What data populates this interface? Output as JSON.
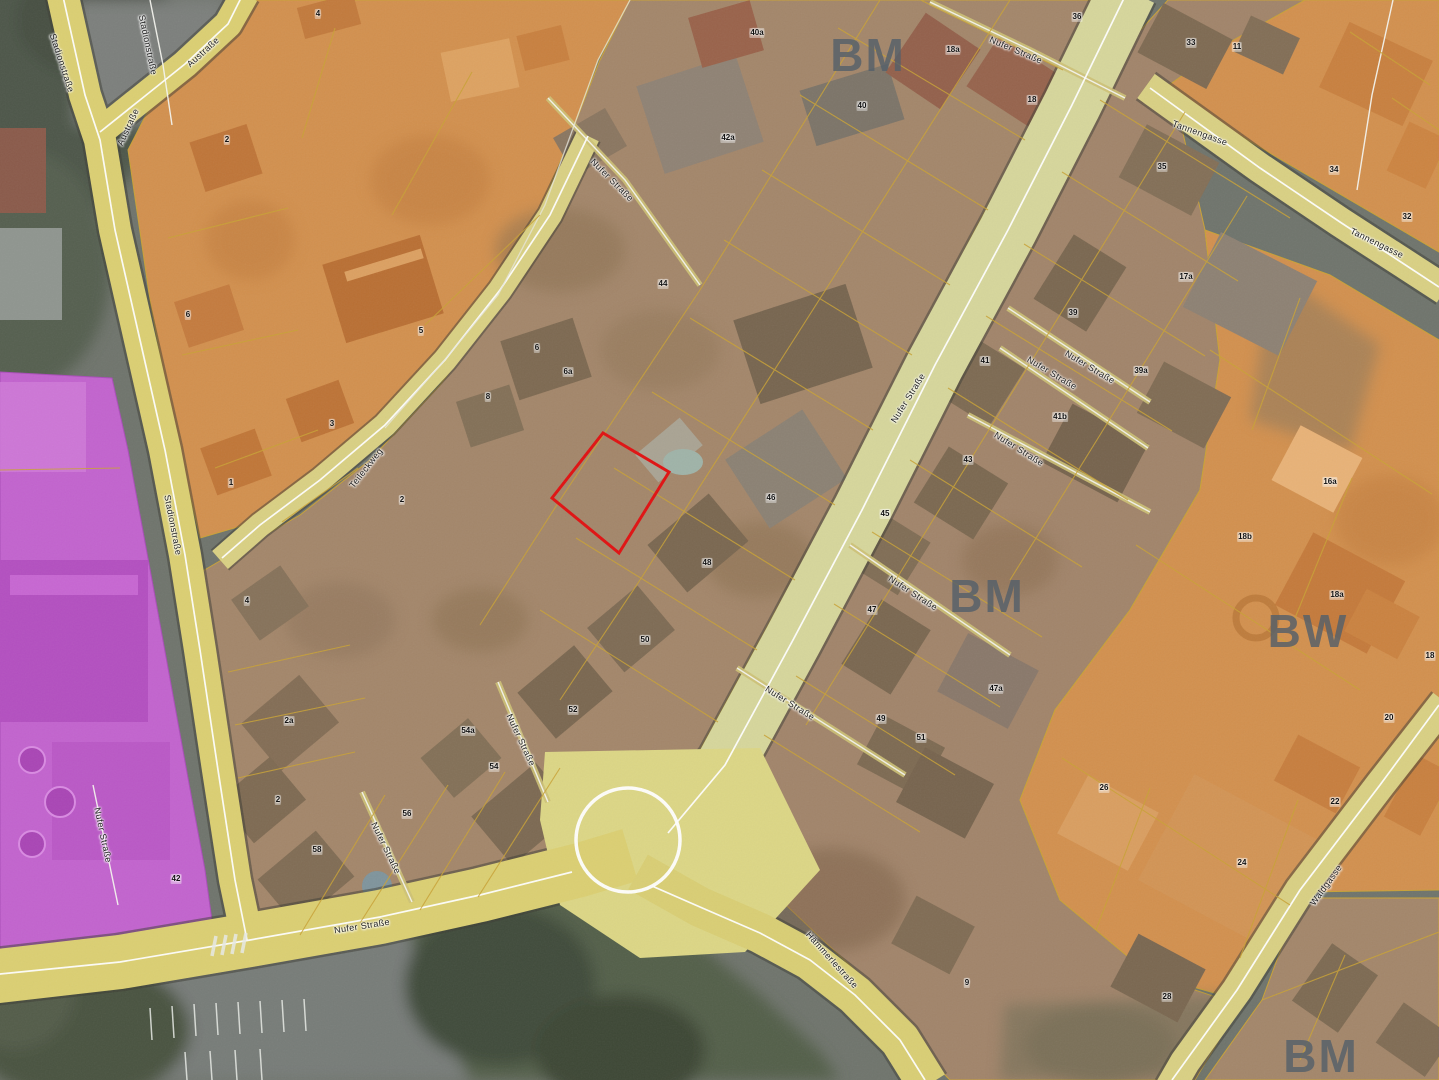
{
  "map": {
    "legend_colors": {
      "highlight_parcel_red": "#e01111",
      "mixed_use_brown": "#a3866a",
      "orange_zone": "#d2904e",
      "utility_purple": "#c263ce",
      "road_yellow": "#dbcf72",
      "aerial_gray": "#6f746c",
      "zone_label_gray": "#55606a"
    },
    "zone_labels": [
      {
        "text": "BM",
        "x": 868,
        "y": 55
      },
      {
        "text": "BM",
        "x": 987,
        "y": 596
      },
      {
        "text": "BW",
        "x": 1308,
        "y": 631
      },
      {
        "text": "BM",
        "x": 1321,
        "y": 1056
      }
    ],
    "street_labels": [
      {
        "text": "Stadionstraße",
        "x": 62,
        "y": 63,
        "rot": 72
      },
      {
        "text": "Stadionstraße",
        "x": 148,
        "y": 45,
        "rot": 78
      },
      {
        "text": "Austraße",
        "x": 203,
        "y": 52,
        "rot": -42
      },
      {
        "text": "Austraße",
        "x": 128,
        "y": 127,
        "rot": -65
      },
      {
        "text": "Stadionstraße",
        "x": 173,
        "y": 525,
        "rot": 79
      },
      {
        "text": "Teileckweg",
        "x": 366,
        "y": 468,
        "rot": -52
      },
      {
        "text": "Nufer Straße",
        "x": 103,
        "y": 835,
        "rot": 78
      },
      {
        "text": "Nufer Straße",
        "x": 362,
        "y": 926,
        "rot": -9
      },
      {
        "text": "Nufer Straße",
        "x": 908,
        "y": 398,
        "rot": -58
      },
      {
        "text": "Nufer Straße",
        "x": 1016,
        "y": 50,
        "rot": 23
      },
      {
        "text": "Nufer Straße",
        "x": 612,
        "y": 180,
        "rot": 45
      },
      {
        "text": "Nufer Straße",
        "x": 1052,
        "y": 373,
        "rot": 31
      },
      {
        "text": "Nufer Straße",
        "x": 1090,
        "y": 367,
        "rot": 31
      },
      {
        "text": "Nufer Straße",
        "x": 1019,
        "y": 449,
        "rot": 32
      },
      {
        "text": "Nufer Straße",
        "x": 913,
        "y": 593,
        "rot": 33
      },
      {
        "text": "Nufer Straße",
        "x": 790,
        "y": 703,
        "rot": 32
      },
      {
        "text": "Nufer Straße",
        "x": 521,
        "y": 740,
        "rot": 65
      },
      {
        "text": "Nufer Straße",
        "x": 386,
        "y": 848,
        "rot": 64
      },
      {
        "text": "Tannengasse",
        "x": 1200,
        "y": 133,
        "rot": 20
      },
      {
        "text": "Tannengasse",
        "x": 1377,
        "y": 243,
        "rot": 26
      },
      {
        "text": "Waldgasse",
        "x": 1326,
        "y": 885,
        "rot": -54
      },
      {
        "text": "Hämmerlestraße",
        "x": 832,
        "y": 960,
        "rot": 48
      }
    ],
    "parcel_numbers": [
      {
        "t": "4",
        "x": 318,
        "y": 14
      },
      {
        "t": "36",
        "x": 1077,
        "y": 17
      },
      {
        "t": "40a",
        "x": 757,
        "y": 33
      },
      {
        "t": "33",
        "x": 1191,
        "y": 43
      },
      {
        "t": "11",
        "x": 1237,
        "y": 47
      },
      {
        "t": "18a",
        "x": 953,
        "y": 50
      },
      {
        "t": "18",
        "x": 1032,
        "y": 100
      },
      {
        "t": "40",
        "x": 862,
        "y": 106
      },
      {
        "t": "42a",
        "x": 728,
        "y": 138
      },
      {
        "t": "2",
        "x": 227,
        "y": 140
      },
      {
        "t": "35",
        "x": 1162,
        "y": 167
      },
      {
        "t": "34",
        "x": 1334,
        "y": 170
      },
      {
        "t": "32",
        "x": 1407,
        "y": 217
      },
      {
        "t": "17a",
        "x": 1186,
        "y": 277
      },
      {
        "t": "44",
        "x": 663,
        "y": 284
      },
      {
        "t": "39",
        "x": 1073,
        "y": 313
      },
      {
        "t": "6",
        "x": 188,
        "y": 315
      },
      {
        "t": "5",
        "x": 421,
        "y": 331
      },
      {
        "t": "6",
        "x": 537,
        "y": 348
      },
      {
        "t": "41",
        "x": 985,
        "y": 361
      },
      {
        "t": "39a",
        "x": 1141,
        "y": 371
      },
      {
        "t": "6a",
        "x": 568,
        "y": 372
      },
      {
        "t": "8",
        "x": 488,
        "y": 397
      },
      {
        "t": "41b",
        "x": 1060,
        "y": 417
      },
      {
        "t": "3",
        "x": 332,
        "y": 424
      },
      {
        "t": "43",
        "x": 968,
        "y": 460
      },
      {
        "t": "16a",
        "x": 1330,
        "y": 482
      },
      {
        "t": "1",
        "x": 231,
        "y": 483
      },
      {
        "t": "46",
        "x": 771,
        "y": 498
      },
      {
        "t": "2",
        "x": 402,
        "y": 500
      },
      {
        "t": "45",
        "x": 885,
        "y": 514
      },
      {
        "t": "18b",
        "x": 1245,
        "y": 537
      },
      {
        "t": "48",
        "x": 707,
        "y": 563
      },
      {
        "t": "18a",
        "x": 1337,
        "y": 595
      },
      {
        "t": "4",
        "x": 247,
        "y": 601
      },
      {
        "t": "47",
        "x": 872,
        "y": 610
      },
      {
        "t": "50",
        "x": 645,
        "y": 640
      },
      {
        "t": "18",
        "x": 1430,
        "y": 656
      },
      {
        "t": "47a",
        "x": 996,
        "y": 689
      },
      {
        "t": "52",
        "x": 573,
        "y": 710
      },
      {
        "t": "20",
        "x": 1389,
        "y": 718
      },
      {
        "t": "49",
        "x": 881,
        "y": 719
      },
      {
        "t": "2a",
        "x": 289,
        "y": 721
      },
      {
        "t": "54a",
        "x": 468,
        "y": 731
      },
      {
        "t": "51",
        "x": 921,
        "y": 738
      },
      {
        "t": "54",
        "x": 494,
        "y": 767
      },
      {
        "t": "26",
        "x": 1104,
        "y": 788
      },
      {
        "t": "2",
        "x": 278,
        "y": 800
      },
      {
        "t": "22",
        "x": 1335,
        "y": 802
      },
      {
        "t": "56",
        "x": 407,
        "y": 814
      },
      {
        "t": "58",
        "x": 317,
        "y": 850
      },
      {
        "t": "24",
        "x": 1242,
        "y": 863
      },
      {
        "t": "42",
        "x": 176,
        "y": 879
      },
      {
        "t": "9",
        "x": 967,
        "y": 983
      },
      {
        "t": "28",
        "x": 1167,
        "y": 997
      }
    ]
  }
}
